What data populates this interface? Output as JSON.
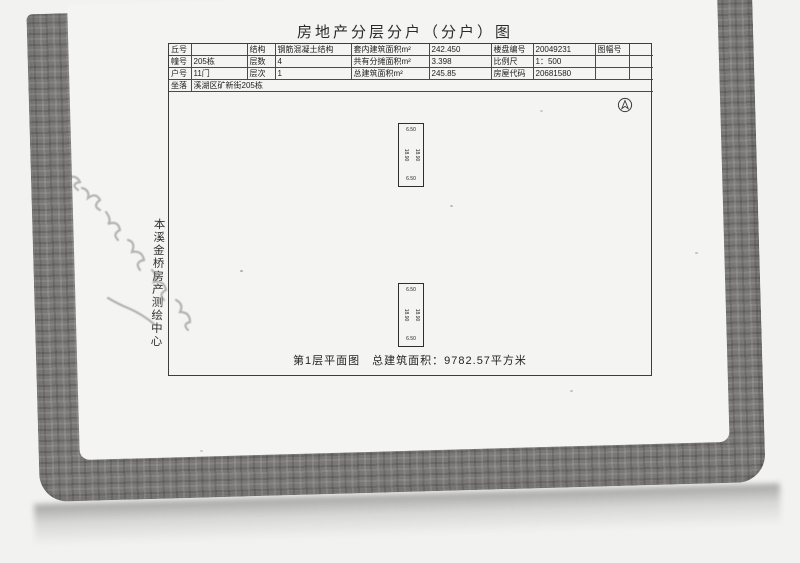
{
  "document": {
    "title": "房地产分层分户（分户）图",
    "info_table": {
      "rows": [
        {
          "c1_label": "丘号",
          "c1_value": "",
          "c2_label": "结构",
          "c2_value": "钢筋混凝土结构",
          "c3_label": "套内建筑面积m²",
          "c3_value": "242.450",
          "c4_label": "楼盘编号",
          "c4_value": "20049231",
          "c5_label": "图幅号",
          "c5_value": ""
        },
        {
          "c1_label": "幢号",
          "c1_value": "205栋",
          "c2_label": "层数",
          "c2_value": "4",
          "c3_label": "共有分摊面积m²",
          "c3_value": "3.398",
          "c4_label": "比例尺",
          "c4_value": "1：500",
          "c5_label": "",
          "c5_value": ""
        },
        {
          "c1_label": "户号",
          "c1_value": "11门",
          "c2_label": "层次",
          "c2_value": "1",
          "c3_label": "总建筑面积m²",
          "c3_value": "245.85",
          "c4_label": "房屋代码",
          "c4_value": "20681580",
          "c5_label": "",
          "c5_value": ""
        }
      ],
      "address_label": "坐落",
      "address_value": "溪湖区矿新街205栋"
    },
    "plan": {
      "units": [
        {
          "top_dim": "6.50",
          "bottom_dim": "6.50",
          "left_dim": "18.90",
          "right_dim": "18.90"
        },
        {
          "top_dim": "6.50",
          "bottom_dim": "6.50",
          "left_dim": "18.90",
          "right_dim": "18.90"
        }
      ],
      "caption": "第1层平面图　总建筑面积：9782.57平方米"
    },
    "stamp_text": "本溪金桥房产测绘中心"
  },
  "colors": {
    "frame_gray": "#7a7876",
    "page_white": "#f4f4f2",
    "line_dark": "#3d3d3d"
  }
}
